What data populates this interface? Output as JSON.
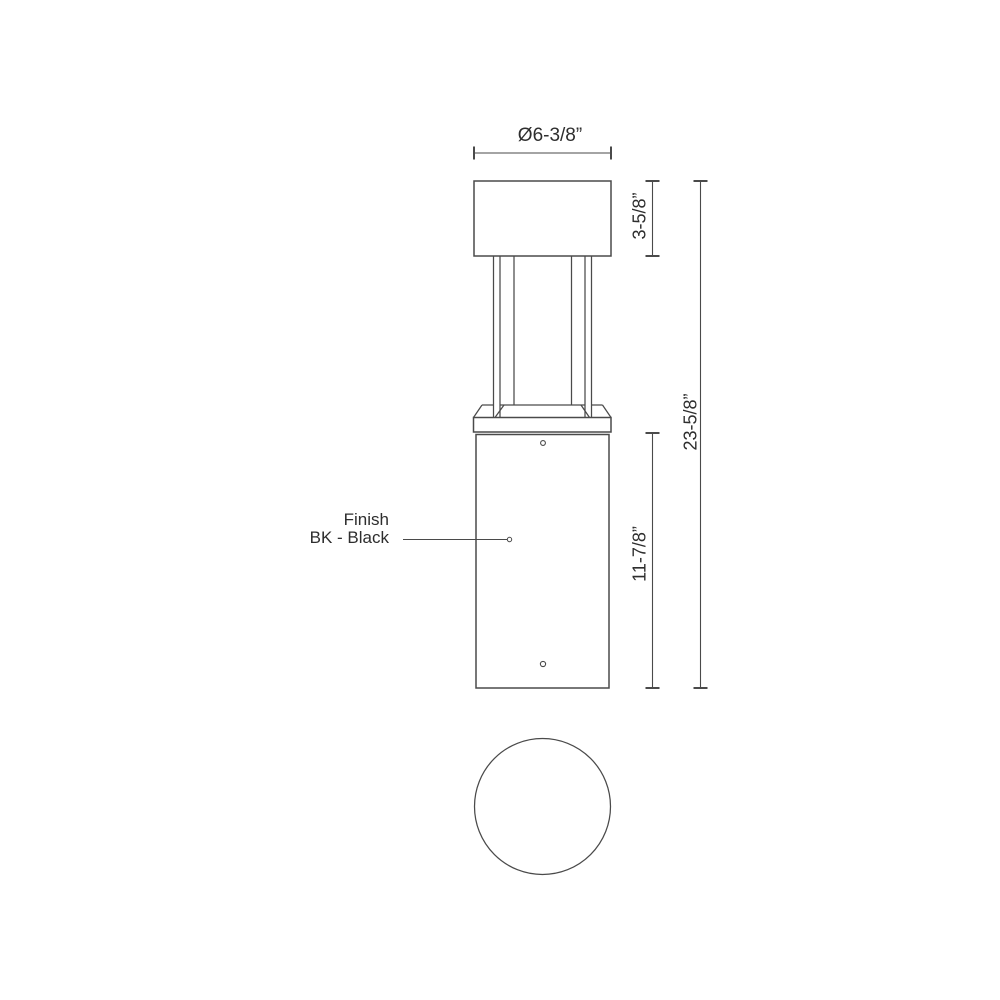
{
  "colors": {
    "background": "#ffffff",
    "line": "#4a4a4a",
    "text": "#2e2e2e"
  },
  "dimensions": {
    "diameter": "Ø6-3/8”",
    "cap_height": "3-5/8”",
    "body_height": "11-7/8”",
    "overall_height": "23-5/8”"
  },
  "finish": {
    "label": "Finish",
    "value": "BK - Black"
  }
}
